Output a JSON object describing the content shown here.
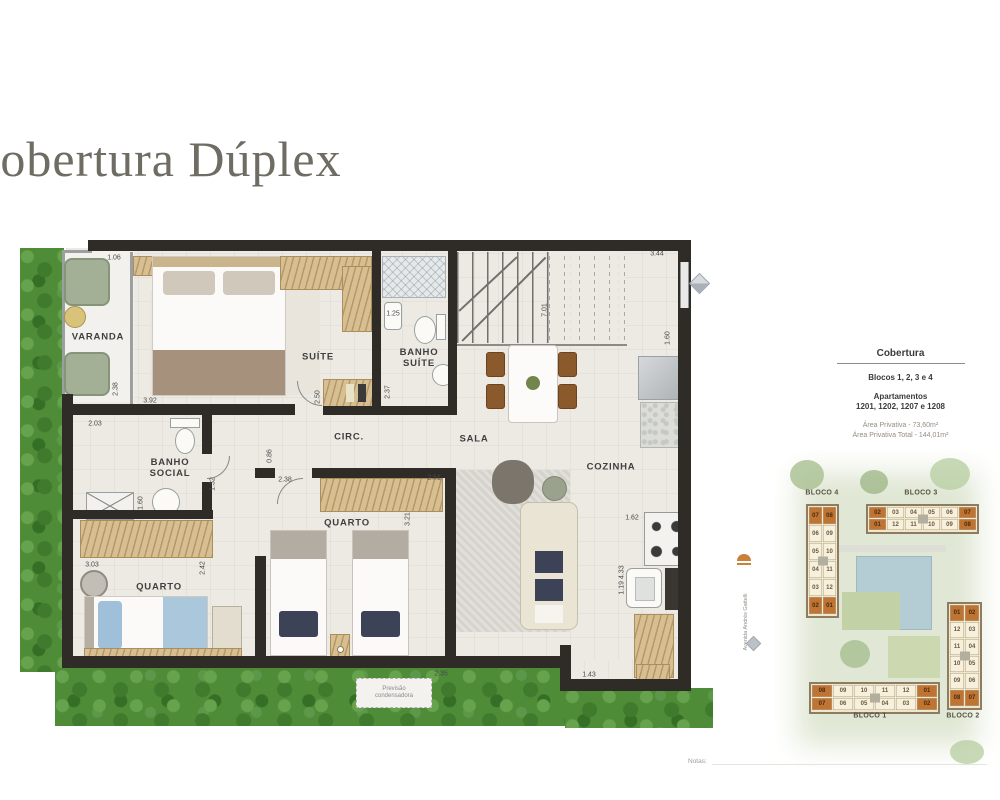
{
  "title": "Cobertura Dúplex",
  "notes_label": "Notas:",
  "colors": {
    "wall": "#2f2b27",
    "grass": "#4e8c38",
    "highlight_unit": "#bf7434",
    "title_text": "#6f6d63",
    "wood": "#d8bf92"
  },
  "icons": {
    "north_compass": "diamond-north-arrow",
    "siteplan_marker": "orange-awning",
    "siteplan_compass": "diamond-compass"
  },
  "info_panel": {
    "title": "Cobertura",
    "blocks_line": "Blocos 1, 2, 3 e 4",
    "apartments_label": "Apartamentos",
    "apartments_numbers": "1201, 1202, 1207 e 1208",
    "private_area": "Área Privativa - 73,60m²",
    "private_area_total": "Área Privativa Total - 144,01m²"
  },
  "floorplan": {
    "condenser_note": "Previsão\ncondensadora",
    "rooms": [
      {
        "id": "varanda",
        "label": "VARANDA",
        "cx": 98,
        "cy": 337
      },
      {
        "id": "suite",
        "label": "SUÍTE",
        "cx": 318,
        "cy": 357
      },
      {
        "id": "banho-suite",
        "label": "BANHO\nSUÍTE",
        "cx": 419,
        "cy": 358
      },
      {
        "id": "circ",
        "label": "CIRC.",
        "cx": 349,
        "cy": 437
      },
      {
        "id": "sala",
        "label": "SALA",
        "cx": 474,
        "cy": 439
      },
      {
        "id": "cozinha",
        "label": "COZINHA",
        "cx": 611,
        "cy": 467
      },
      {
        "id": "banho-social",
        "label": "BANHO\nSOCIAL",
        "cx": 170,
        "cy": 468
      },
      {
        "id": "quarto-2",
        "label": "QUARTO",
        "cx": 347,
        "cy": 523
      },
      {
        "id": "quarto-1",
        "label": "QUARTO",
        "cx": 159,
        "cy": 587
      }
    ],
    "dimensions": [
      {
        "v": "1.06",
        "cx": 114,
        "cy": 258
      },
      {
        "v": "3.44",
        "cx": 657,
        "cy": 254
      },
      {
        "v": "7.01",
        "cx": 545,
        "cy": 310,
        "r": 1
      },
      {
        "v": "1.25",
        "cx": 393,
        "cy": 314
      },
      {
        "v": "2.37",
        "cx": 388,
        "cy": 392,
        "r": 1
      },
      {
        "v": "2.50",
        "cx": 318,
        "cy": 397,
        "r": 1
      },
      {
        "v": "3.92",
        "cx": 150,
        "cy": 401
      },
      {
        "v": "2.38",
        "cx": 116,
        "cy": 389,
        "r": 1
      },
      {
        "v": "2.03",
        "cx": 95,
        "cy": 424
      },
      {
        "v": "1.60",
        "cx": 141,
        "cy": 503,
        "r": 1
      },
      {
        "v": "1.32",
        "cx": 213,
        "cy": 484,
        "r": 1
      },
      {
        "v": "0.86",
        "cx": 270,
        "cy": 456,
        "r": 1
      },
      {
        "v": "2.38",
        "cx": 285,
        "cy": 480
      },
      {
        "v": "2.51",
        "cx": 434,
        "cy": 478
      },
      {
        "v": "3.21",
        "cx": 408,
        "cy": 519,
        "r": 1
      },
      {
        "v": "1.60",
        "cx": 668,
        "cy": 338,
        "r": 1
      },
      {
        "v": "3.03",
        "cx": 92,
        "cy": 565
      },
      {
        "v": "2.42",
        "cx": 203,
        "cy": 568,
        "r": 1
      },
      {
        "v": "1.62",
        "cx": 632,
        "cy": 518
      },
      {
        "v": "1.19 4.33",
        "cx": 622,
        "cy": 580,
        "r": 1
      },
      {
        "v": "2.35",
        "cx": 441,
        "cy": 674
      },
      {
        "v": "1.43",
        "cx": 589,
        "cy": 675
      }
    ]
  },
  "siteplan": {
    "street_label": "Avenida Andrés Gattelli",
    "blocks": [
      {
        "id": "bloco-4",
        "label": "BLOCO 4",
        "x": 806,
        "y": 504,
        "cellw": 13,
        "cellh": 17,
        "label_cx": 822,
        "label_cy": 493,
        "rows": [
          [
            "07",
            "08"
          ],
          [
            "06",
            "09"
          ],
          [
            "05",
            "10"
          ],
          [
            "04",
            "11"
          ],
          [
            "03",
            "12"
          ],
          [
            "02",
            "01"
          ]
        ],
        "highlight": [
          "07",
          "08",
          "01",
          "02"
        ]
      },
      {
        "id": "bloco-3",
        "label": "BLOCO 3",
        "x": 866,
        "y": 504,
        "cellw": 17,
        "cellh": 11,
        "label_cx": 921,
        "label_cy": 493,
        "rows": [
          [
            "02",
            "03",
            "04",
            "05",
            "06",
            "07"
          ],
          [
            "01",
            "12",
            "11",
            "10",
            "09",
            "08"
          ]
        ],
        "highlight": [
          "02",
          "07",
          "01",
          "08"
        ]
      },
      {
        "id": "bloco-1",
        "label": "BLOCO 1",
        "x": 809,
        "y": 682,
        "cellw": 20,
        "cellh": 12,
        "label_cx": 870,
        "label_cy": 716,
        "rows": [
          [
            "08",
            "09",
            "10",
            "11",
            "12",
            "01"
          ],
          [
            "07",
            "06",
            "05",
            "04",
            "03",
            "02"
          ]
        ],
        "highlight": [
          "08",
          "01",
          "07",
          "02"
        ]
      },
      {
        "id": "bloco-2",
        "label": "BLOCO 2",
        "x": 947,
        "y": 602,
        "cellw": 14,
        "cellh": 16,
        "label_cx": 963,
        "label_cy": 716,
        "rows": [
          [
            "01",
            "02"
          ],
          [
            "12",
            "03"
          ],
          [
            "11",
            "04"
          ],
          [
            "10",
            "05"
          ],
          [
            "09",
            "06"
          ],
          [
            "08",
            "07"
          ]
        ],
        "highlight": [
          "01",
          "02",
          "08",
          "07"
        ]
      }
    ]
  }
}
